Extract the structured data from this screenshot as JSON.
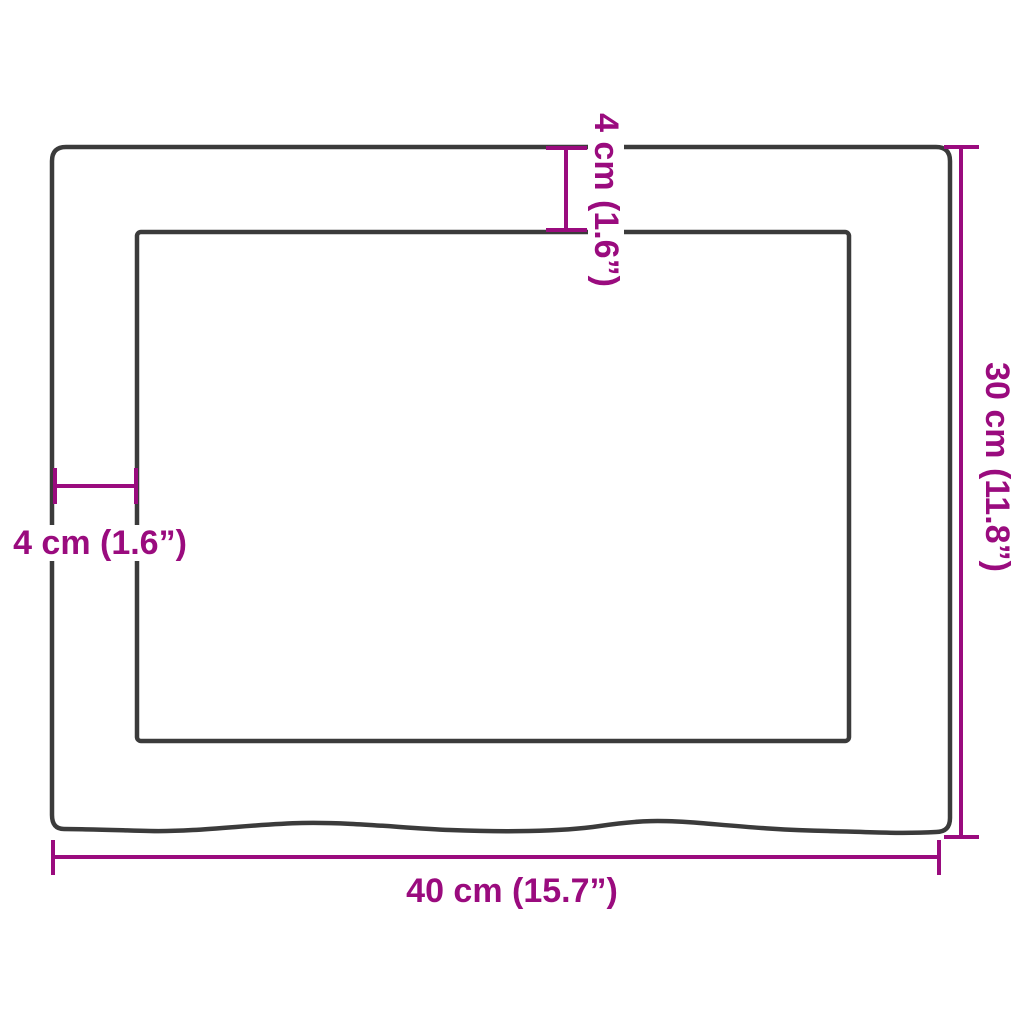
{
  "page": {
    "background": "#ffffff"
  },
  "diagram": {
    "type": "product-dimension-diagram",
    "subject": "rectangular panel with inner recess and natural wavy bottom edge",
    "colors": {
      "outline": "#3b3b3b",
      "dimension": "#9a0b7e"
    },
    "dimensions": {
      "width_label": "40 cm (15.7”)",
      "height_label": "30 cm (11.8”)",
      "top_inset_label": "4 cm (1.6”)",
      "left_inset_label": "4 cm (1.6”)"
    }
  }
}
